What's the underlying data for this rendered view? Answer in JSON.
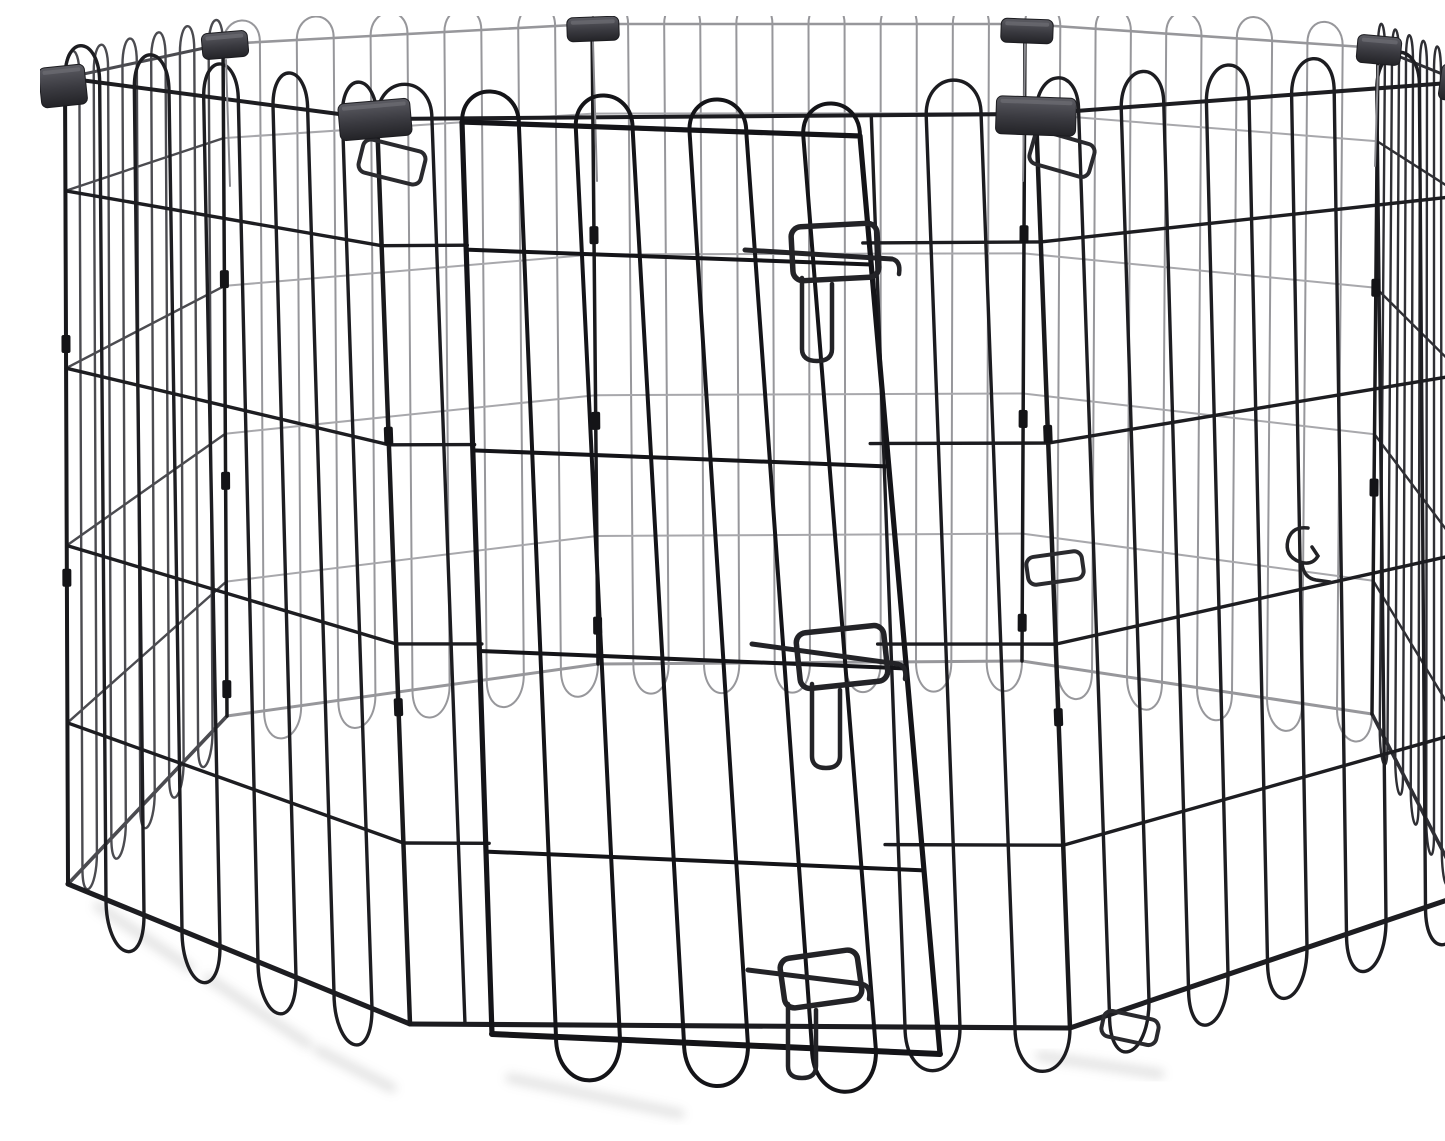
{
  "meta": {
    "description": "Product photo: black foldable 8-panel metal wire pet exercise playpen with arched-top wires, eight dark plastic corner clips, and a front door secured by three slide-bolt latches, on a plain white background.",
    "background": "#ffffff"
  },
  "palette": {
    "wire_front": "#1d1d21",
    "wire_door": "#141418",
    "wire_side_left": "#4b4b50",
    "wire_side_right": "#2f2f34",
    "wire_back": "#97979b",
    "wire_back_rail": "#a8a8ac",
    "post": "#19191c",
    "sleeve": "#141417",
    "clip_top": "#5c5c63",
    "clip_bottom": "#232327",
    "latch": "#232327",
    "hanger_wire": "#8a8a8f",
    "shadow": "#9a9a9a"
  },
  "scene": {
    "canvas": {
      "width": 1445,
      "height": 1109,
      "background": "#ffffff"
    },
    "panels": [
      {
        "name": "back-left",
        "tl": [
          183,
          28
        ],
        "tr": [
          552,
          8
        ],
        "br": [
          558,
          648
        ],
        "bl": [
          187,
          700
        ],
        "wires": 11,
        "color": "#97979b",
        "railColor": "#a8a8ac",
        "w": 2,
        "arcH": 30,
        "loopH": 40,
        "rails": [
          0.14,
          0.36,
          0.58,
          0.8
        ]
      },
      {
        "name": "back-center",
        "tl": [
          552,
          8
        ],
        "tr": [
          985,
          8
        ],
        "br": [
          982,
          645
        ],
        "bl": [
          558,
          648
        ],
        "wires": 13,
        "color": "#97979b",
        "railColor": "#a8a8ac",
        "w": 2,
        "arcH": 30,
        "loopH": 40,
        "rails": [
          0.14,
          0.36,
          0.58,
          0.8
        ]
      },
      {
        "name": "back-right",
        "tl": [
          985,
          8
        ],
        "tr": [
          1338,
          32
        ],
        "br": [
          1332,
          698
        ],
        "bl": [
          982,
          645
        ],
        "wires": 11,
        "color": "#97979b",
        "railColor": "#a8a8ac",
        "w": 2,
        "arcH": 30,
        "loopH": 40,
        "rails": [
          0.14,
          0.36,
          0.58,
          0.8
        ]
      },
      {
        "name": "side-left",
        "tl": [
          25,
          62
        ],
        "tr": [
          183,
          28
        ],
        "br": [
          187,
          700
        ],
        "bl": [
          28,
          868
        ],
        "wires": 12,
        "color": "#4b4b50",
        "w": 2.4,
        "arcH": 34,
        "loopH": 36,
        "rails": [
          0.14,
          0.36,
          0.58,
          0.8
        ]
      },
      {
        "name": "side-right",
        "tl": [
          1338,
          32
        ],
        "tr": [
          1422,
          66
        ],
        "br": [
          1425,
          878
        ],
        "bl": [
          1332,
          698
        ],
        "wires": 13,
        "color": "#2f2f34",
        "w": 2.4,
        "arcH": 34,
        "loopH": 36,
        "rails": [
          0.14,
          0.36,
          0.58,
          0.8
        ]
      },
      {
        "name": "front-left",
        "tl": [
          25,
          62
        ],
        "tr": [
          337,
          103
        ],
        "br": [
          370,
          1008
        ],
        "bl": [
          28,
          868
        ],
        "wires": 10,
        "color": "#1d1d21",
        "w": 3.4,
        "arcH": 46,
        "loopH": 58,
        "rails": [
          0.14,
          0.36,
          0.58,
          0.8
        ]
      },
      {
        "name": "front-right",
        "tl": [
          996,
          98
        ],
        "tr": [
          1422,
          66
        ],
        "br": [
          1425,
          878
        ],
        "bl": [
          1030,
          1012
        ],
        "wires": 11,
        "color": "#1d1d21",
        "w": 3.4,
        "arcH": 46,
        "loopH": 58,
        "rails": [
          0.14,
          0.36,
          0.58,
          0.8
        ]
      },
      {
        "name": "front-door-panel",
        "tl": [
          337,
          103
        ],
        "tr": [
          996,
          98
        ],
        "br": [
          1030,
          1012
        ],
        "bl": [
          370,
          1008
        ],
        "wires": 13,
        "color": "#1c1c20",
        "w": 3.4,
        "arcH": 46,
        "loopH": 58,
        "rails": [
          0.14,
          0.36,
          0.58,
          0.8
        ],
        "cutout": [
          0.13,
          0.73
        ],
        "railGap": [
          0.13,
          0.73
        ]
      }
    ],
    "door": {
      "name": "door",
      "tl": [
        422,
        106
      ],
      "tr": [
        820,
        120
      ],
      "br": [
        900,
        1038
      ],
      "bl": [
        452,
        1018
      ],
      "wires": 8,
      "color": "#141418",
      "w": 4,
      "arcH": 42,
      "loopH": 56,
      "rails": [
        0.14,
        0.36,
        0.58,
        0.8
      ],
      "frame": true
    },
    "posts": [
      {
        "name": "left",
        "top": [
          25,
          62
        ],
        "bot": [
          28,
          868
        ],
        "w": 4,
        "sleeves": [
          0.33,
          0.62
        ]
      },
      {
        "name": "back-left",
        "top": [
          183,
          28
        ],
        "bot": [
          187,
          700
        ],
        "w": 3.5,
        "sleeves": [
          0.35,
          0.65,
          0.96
        ]
      },
      {
        "name": "back-midleft",
        "top": [
          552,
          8
        ],
        "bot": [
          558,
          648
        ],
        "w": 3.5,
        "sleeves": [
          0.33,
          0.62,
          0.94
        ]
      },
      {
        "name": "back-midright",
        "top": [
          985,
          8
        ],
        "bot": [
          982,
          645
        ],
        "w": 3.5,
        "sleeves": [
          0.33,
          0.62,
          0.94
        ]
      },
      {
        "name": "back-right",
        "top": [
          1338,
          32
        ],
        "bot": [
          1332,
          698
        ],
        "w": 3.5,
        "sleeves": [
          0.36,
          0.66
        ]
      },
      {
        "name": "right",
        "top": [
          1422,
          66
        ],
        "bot": [
          1425,
          878
        ],
        "w": 4,
        "sleeves": [
          0.34
        ]
      },
      {
        "name": "front-left",
        "top": [
          337,
          103
        ],
        "bot": [
          370,
          1008
        ],
        "w": 4.5,
        "sleeves": [
          0.35,
          0.65
        ]
      },
      {
        "name": "front-right",
        "top": [
          996,
          98
        ],
        "bot": [
          1030,
          1012
        ],
        "w": 4.5,
        "sleeves": [
          0.35,
          0.66
        ]
      }
    ],
    "clips": [
      {
        "name": "left",
        "x": 0,
        "y": 50,
        "w": 46,
        "h": 40,
        "rot": -6
      },
      {
        "name": "back-left",
        "x": 162,
        "y": 16,
        "w": 46,
        "h": 26,
        "rot": -5
      },
      {
        "name": "back-midleft",
        "x": 527,
        "y": 1,
        "w": 52,
        "h": 24,
        "rot": -2
      },
      {
        "name": "back-midright",
        "x": 961,
        "y": 3,
        "w": 52,
        "h": 24,
        "rot": 2
      },
      {
        "name": "back-right",
        "x": 1317,
        "y": 20,
        "w": 44,
        "h": 28,
        "rot": 5
      },
      {
        "name": "right",
        "x": 1400,
        "y": 50,
        "w": 44,
        "h": 36,
        "rot": 8
      },
      {
        "name": "front-left",
        "x": 299,
        "y": 85,
        "w": 72,
        "h": 37,
        "rot": -5
      },
      {
        "name": "front-right",
        "x": 956,
        "y": 81,
        "w": 80,
        "h": 38,
        "rot": 2
      }
    ],
    "clip_hangers": [
      {
        "a": [
          186,
          44
        ],
        "b": [
          190,
          170
        ]
      },
      {
        "a": [
          553,
          26
        ],
        "b": [
          557,
          165
        ]
      },
      {
        "a": [
          985,
          28
        ],
        "b": [
          983,
          165
        ]
      },
      {
        "a": [
          1338,
          50
        ],
        "b": [
          1335,
          150
        ]
      }
    ],
    "hinge_brackets": [
      {
        "cx": 352,
        "cy": 146,
        "w": 64,
        "h": 34,
        "rot": 14
      },
      {
        "cx": 1022,
        "cy": 138,
        "w": 62,
        "h": 34,
        "rot": 16
      },
      {
        "cx": 1015,
        "cy": 552,
        "w": 56,
        "h": 28,
        "rot": -8
      },
      {
        "cx": 1090,
        "cy": 1012,
        "w": 56,
        "h": 26,
        "rot": 12
      }
    ],
    "latches": [
      {
        "name": "top",
        "rod": [
          [
            705,
            234
          ],
          [
            852,
            243
          ]
        ],
        "bracket": {
          "cx": 795,
          "cy": 236,
          "w": 86,
          "h": 54,
          "rot": -3
        },
        "keeper": [
          762,
          262,
          792,
          345
        ]
      },
      {
        "name": "middle",
        "rod": [
          [
            712,
            628
          ],
          [
            858,
            648
          ]
        ],
        "bracket": {
          "cx": 802,
          "cy": 641,
          "w": 88,
          "h": 56,
          "rot": -6
        },
        "keeper": [
          772,
          668,
          800,
          752
        ]
      },
      {
        "name": "bottom",
        "rod": [
          [
            708,
            954
          ],
          [
            822,
            968
          ]
        ],
        "bracket": {
          "cx": 781,
          "cy": 963,
          "w": 78,
          "h": 50,
          "rot": -8
        },
        "keeper": [
          748,
          988,
          776,
          1062
        ]
      }
    ],
    "hook": {
      "d": "M1268,512 q-16,-2 -20,12 q-4,16 12,22 q12,4 18,-6 l-6,-9 M1262,548 q2,14 14,16 l14,2"
    },
    "shadows": [
      {
        "a": [
          58,
          890
        ],
        "b": [
          150,
          952
        ]
      },
      {
        "a": [
          168,
          962
        ],
        "b": [
          268,
          1028
        ]
      },
      {
        "a": [
          278,
          1034
        ],
        "b": [
          352,
          1072
        ]
      },
      {
        "a": [
          470,
          1062
        ],
        "b": [
          640,
          1098
        ]
      },
      {
        "a": [
          1000,
          1040
        ],
        "b": [
          1120,
          1058
        ]
      }
    ]
  }
}
